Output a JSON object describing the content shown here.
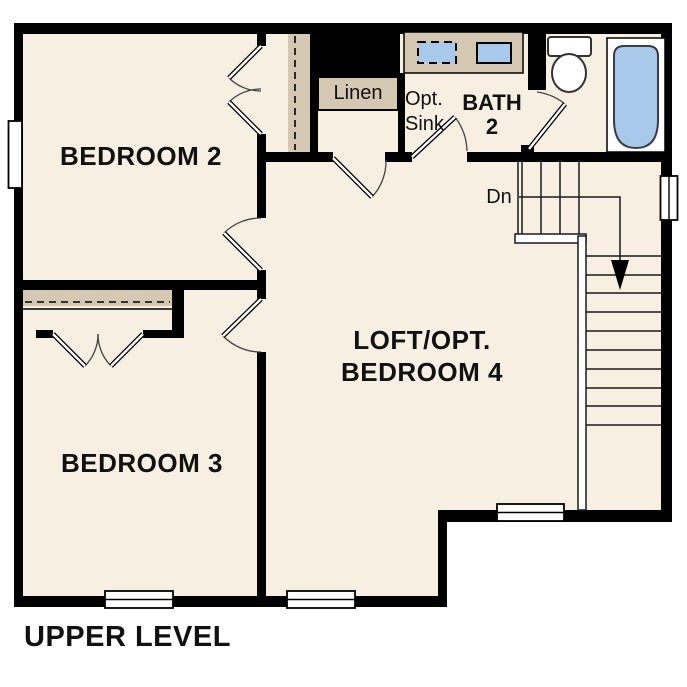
{
  "plan_title": "UPPER LEVEL",
  "labels": {
    "bedroom2": "BEDROOM 2",
    "bedroom3": "BEDROOM 3",
    "loft": "LOFT/OPT.\nBEDROOM 4",
    "bath": "BATH\n2",
    "linen": "Linen",
    "opt_sink": "Opt.\nSink",
    "stairs_down": "Dn"
  },
  "colors": {
    "floor": "#f6efe2",
    "wall": "#000000",
    "closet_shelf": "#d4c8b2",
    "fixture_blue": "#a9c9ea",
    "background": "#ffffff"
  }
}
